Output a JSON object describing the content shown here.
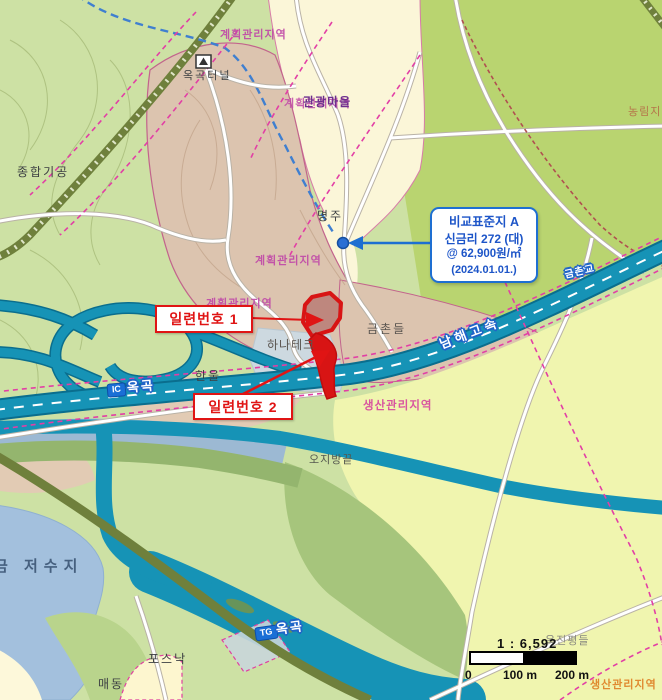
{
  "map_title": "cadastral land-use map (Korea)",
  "labels": {
    "zone_top": "계획관리지역",
    "tunnel": "옥곡터널",
    "jonghap_gigong": "종합기공",
    "village_zone_overlay": "계획관리지역",
    "village": "관광마을",
    "nonglim": "농림지역",
    "myeongju": "명주",
    "zone_mid": "계획관리지역",
    "zone_low": "계획관리지역",
    "geumchon_field": "금촌들",
    "hanatech": "하나테크",
    "hanul": "한울",
    "saengsan_mid": "생산관리지역",
    "ojibang": "오지방끝",
    "reservoir": "금 저수지",
    "posnak": "포스낙",
    "maedong": "매동",
    "okjin_field": "옥진평들",
    "saengsan_bottom": "생산관리지역",
    "highway_name": "남해고속",
    "bridge": "금촌교",
    "ic_badge": "IC",
    "ic_name": "옥곡",
    "tg_badge": "TG",
    "tg_name": "옥곡"
  },
  "callouts": {
    "serial1": "일련번호 1",
    "serial2": "일련번호 2",
    "standard_lot": {
      "line1": "비교표준지  A",
      "line2": "신금리 272 (대)",
      "line3": "@ 62,900원/㎡",
      "line4": "(2024.01.01.)"
    }
  },
  "scale": {
    "ratio": "1 : 6,592",
    "tick0": "0",
    "tick100": "100 m",
    "tick200": "200 m"
  },
  "colors": {
    "highway_teal": "#1693b6",
    "parcel_red": "#d81414",
    "callout_red": "#e01414",
    "callout_blue": "#1e6fd2",
    "zone_magenta": "#c04aa8",
    "forest_green": "#cde1a4",
    "field_green": "#b9d470",
    "village_cream": "#fbf6d8",
    "zone_brown": "#dcc4af",
    "water_blue": "#a3c0dd"
  }
}
